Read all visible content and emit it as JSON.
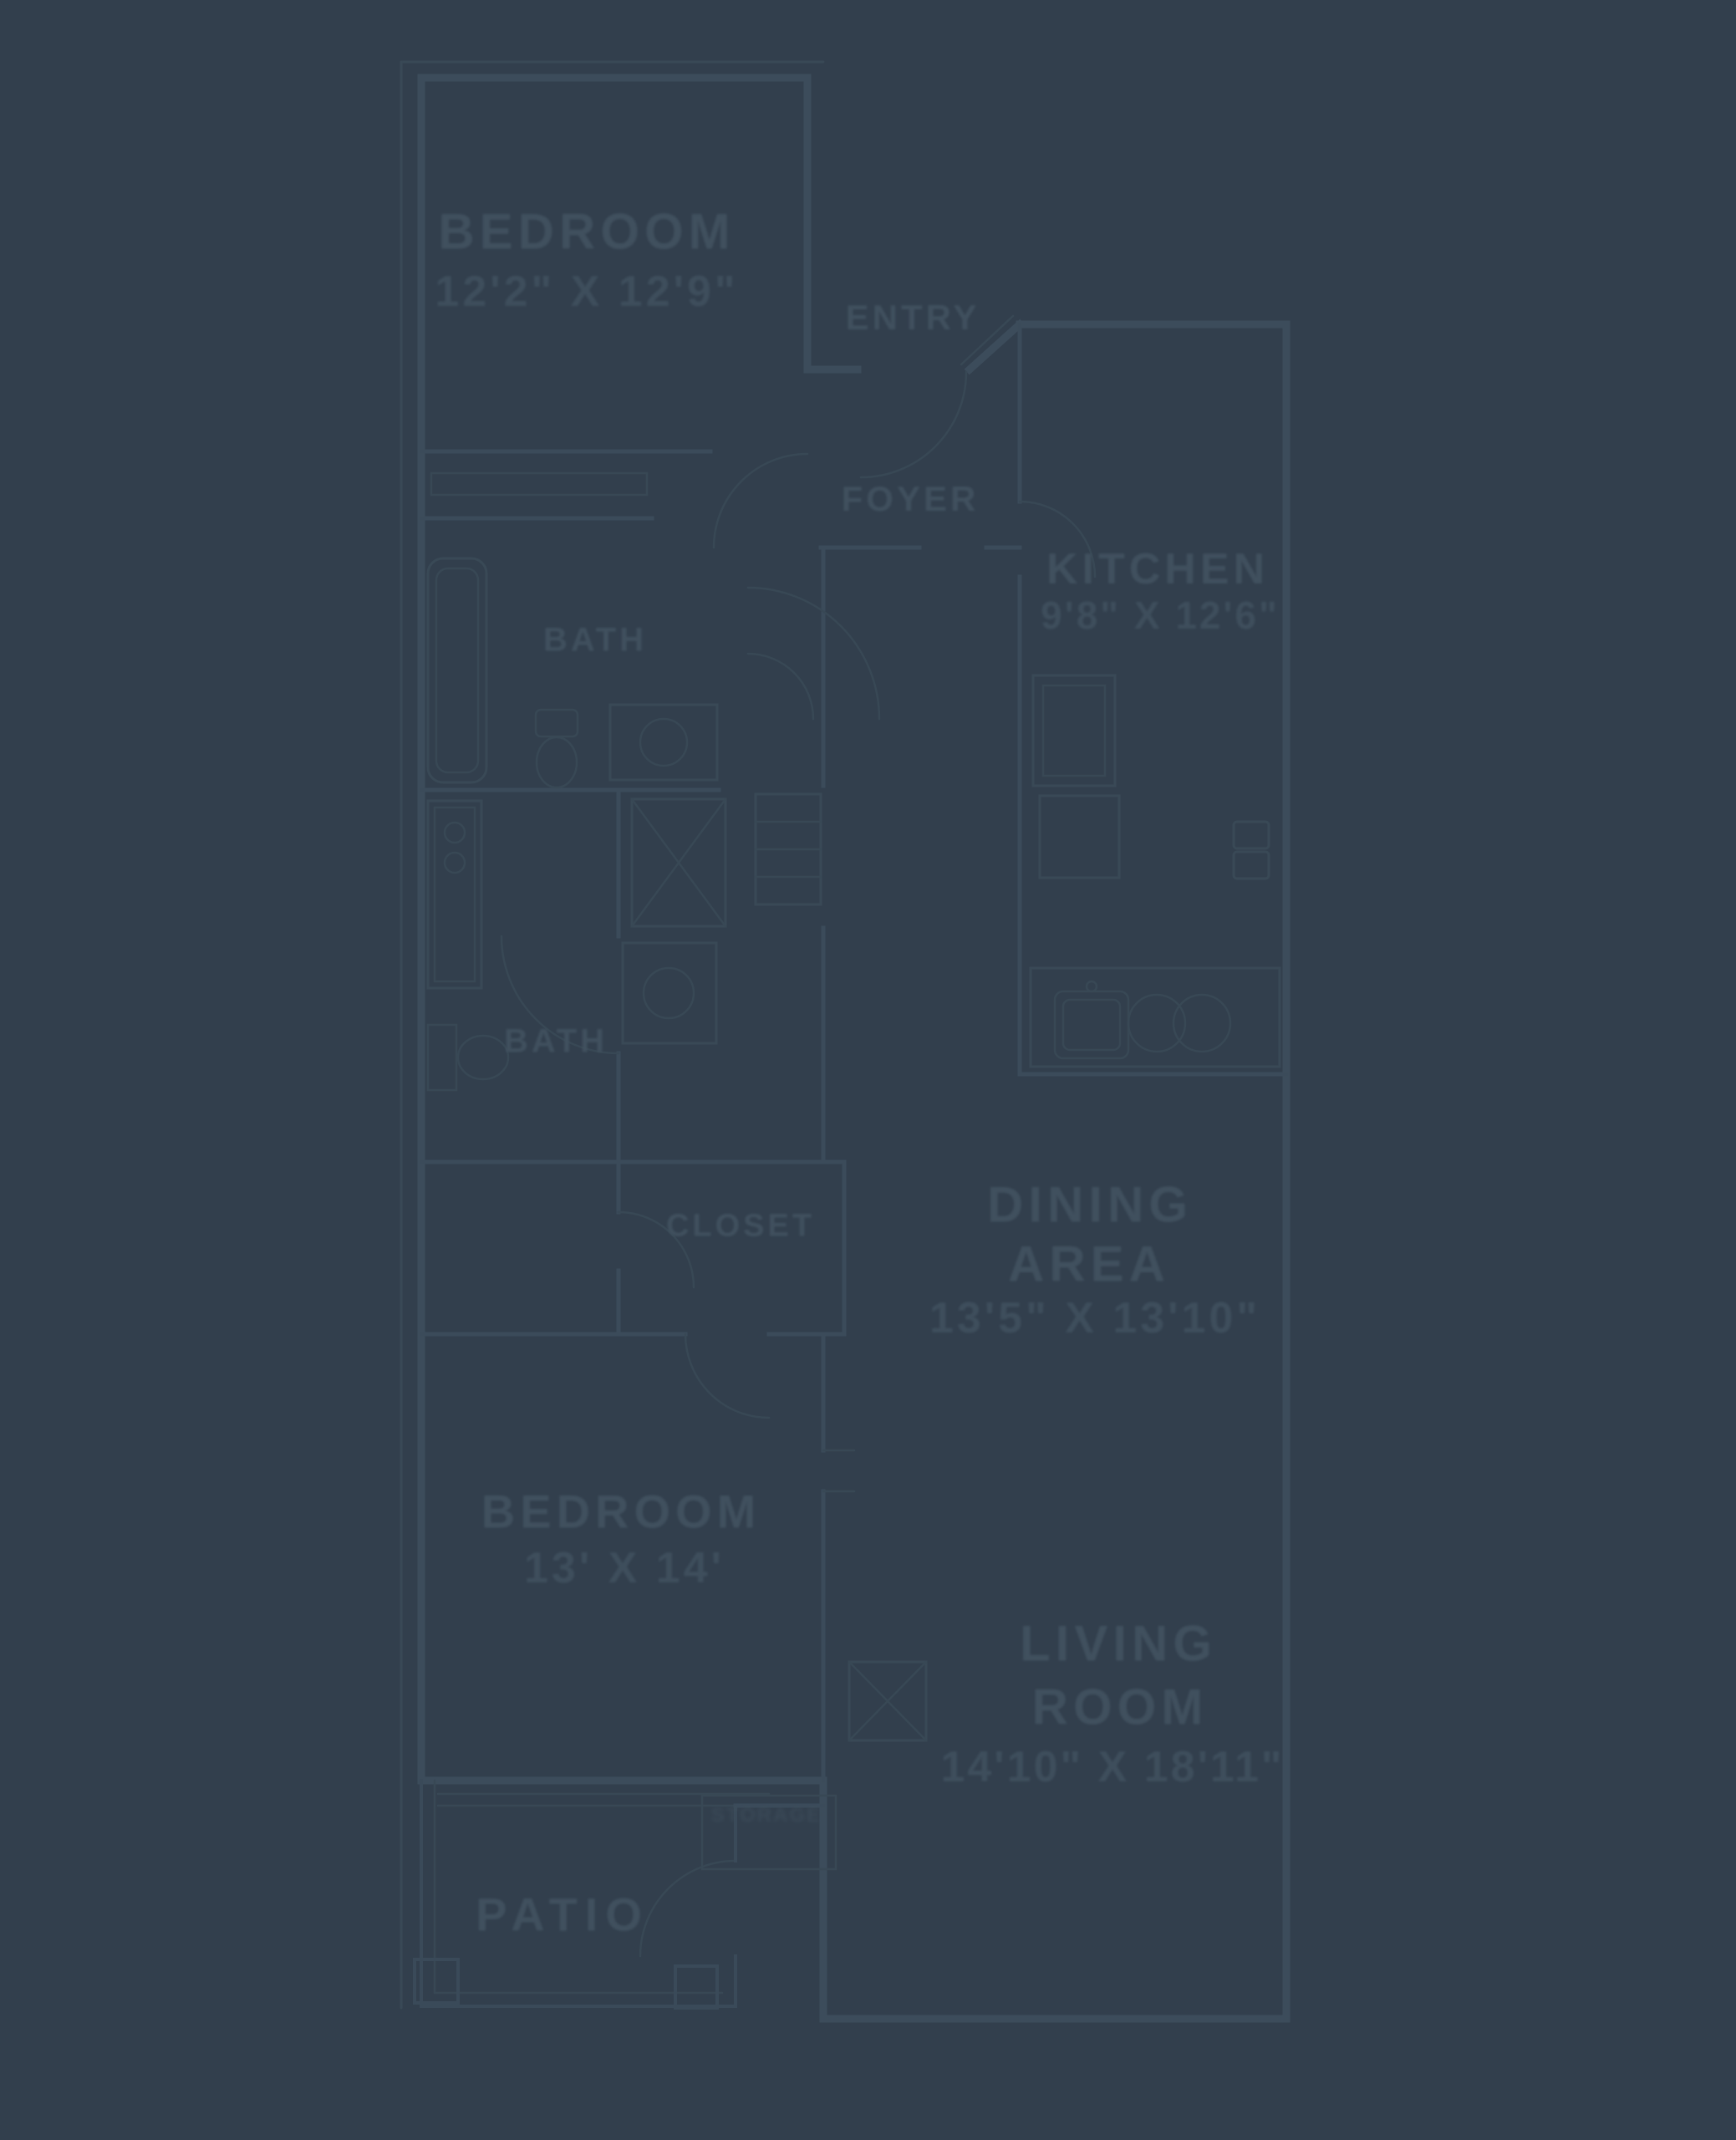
{
  "palette": {
    "background": "#323F4D",
    "wall_line": "#3C4C5B",
    "thin_line": "#394956",
    "text": "#41515F"
  },
  "plan": {
    "type": "apartment-floor-plan",
    "rooms": {
      "bedroom1": {
        "name": "BEDROOM",
        "dims": "12'2\" X 12'9\""
      },
      "entry": {
        "name": "ENTRY"
      },
      "foyer": {
        "name": "FOYER"
      },
      "kitchen": {
        "name": "KITCHEN",
        "dims": "9'8\" X 12'6\""
      },
      "bath1": {
        "name": "BATH"
      },
      "bath2": {
        "name": "BATH"
      },
      "closet": {
        "name": "CLOSET"
      },
      "dining": {
        "name_line1": "DINING",
        "name_line2": "AREA",
        "dims": "13'5\" X 13'10\""
      },
      "bedroom2": {
        "name": "BEDROOM",
        "dims": "13' X 14'"
      },
      "living": {
        "name_line1": "LIVING",
        "name_line2": "ROOM",
        "dims": "14'10\" X 18'11\""
      },
      "patio": {
        "name": "PATIO"
      },
      "storage": {
        "name": "STORAGE"
      }
    }
  }
}
